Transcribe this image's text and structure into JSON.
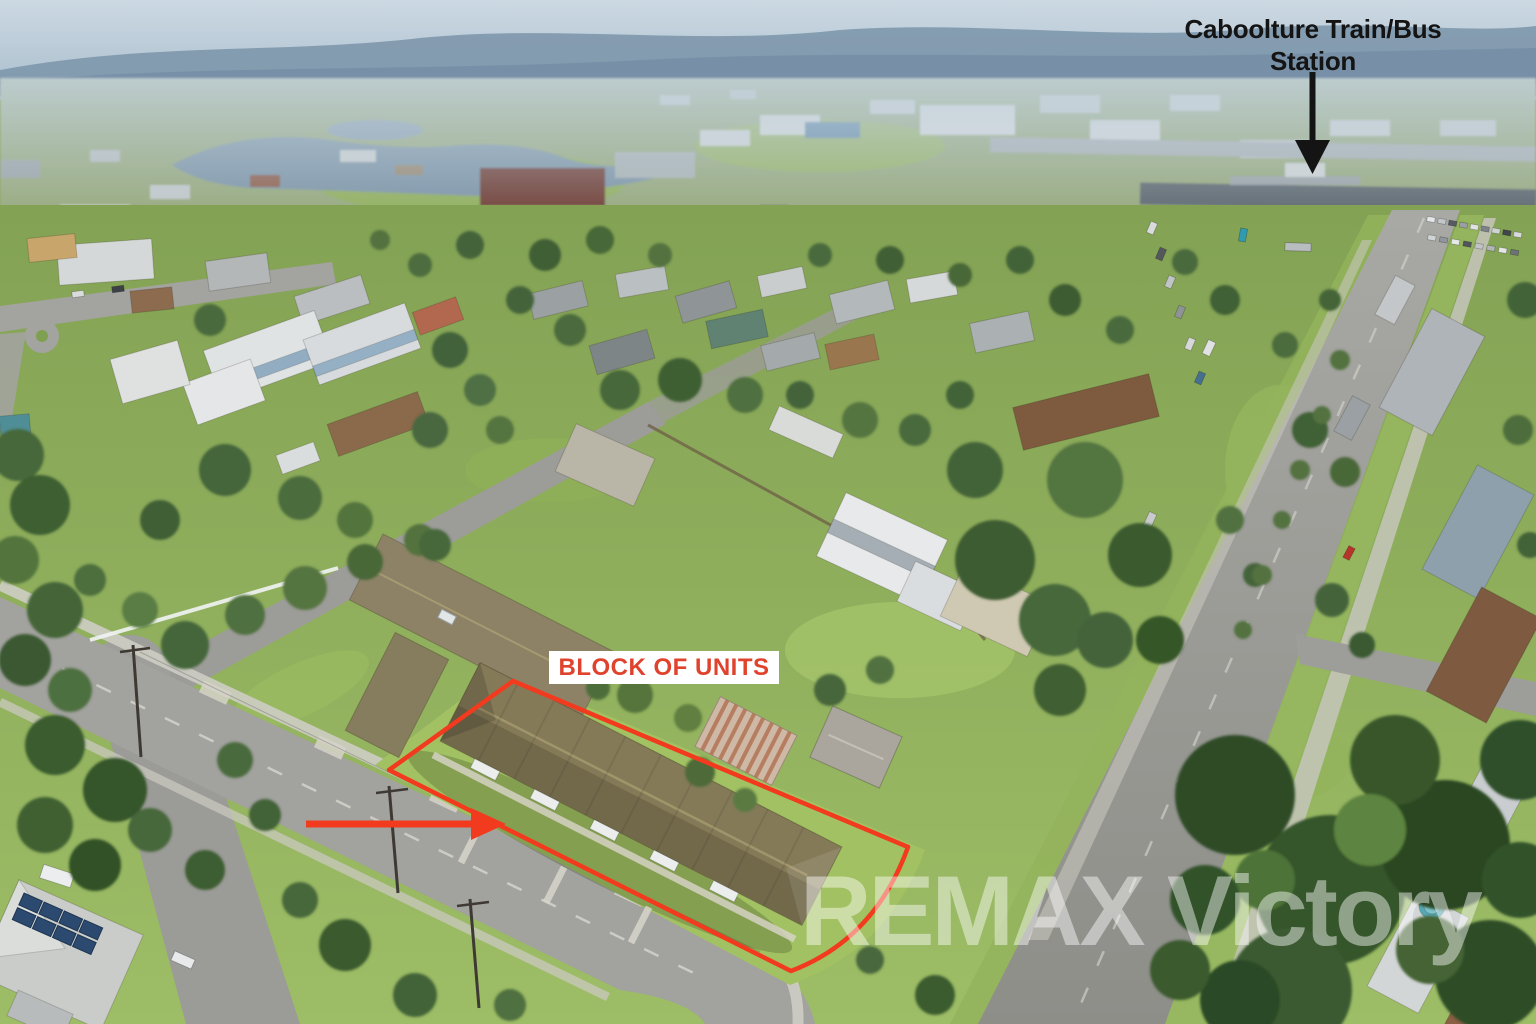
{
  "colors": {
    "annotation-red": "#f23a1f",
    "label-red": "#e0432d",
    "label-bg": "#ffffff",
    "station-black": "#141414",
    "watermark-white": "#ffffff"
  },
  "annotations": {
    "station_label": {
      "line1": "Caboolture Train/Bus",
      "line2": "Station"
    },
    "units_label": {
      "text": "BLOCK OF UNITS"
    },
    "watermark": {
      "text": "REMAX Victory"
    }
  }
}
